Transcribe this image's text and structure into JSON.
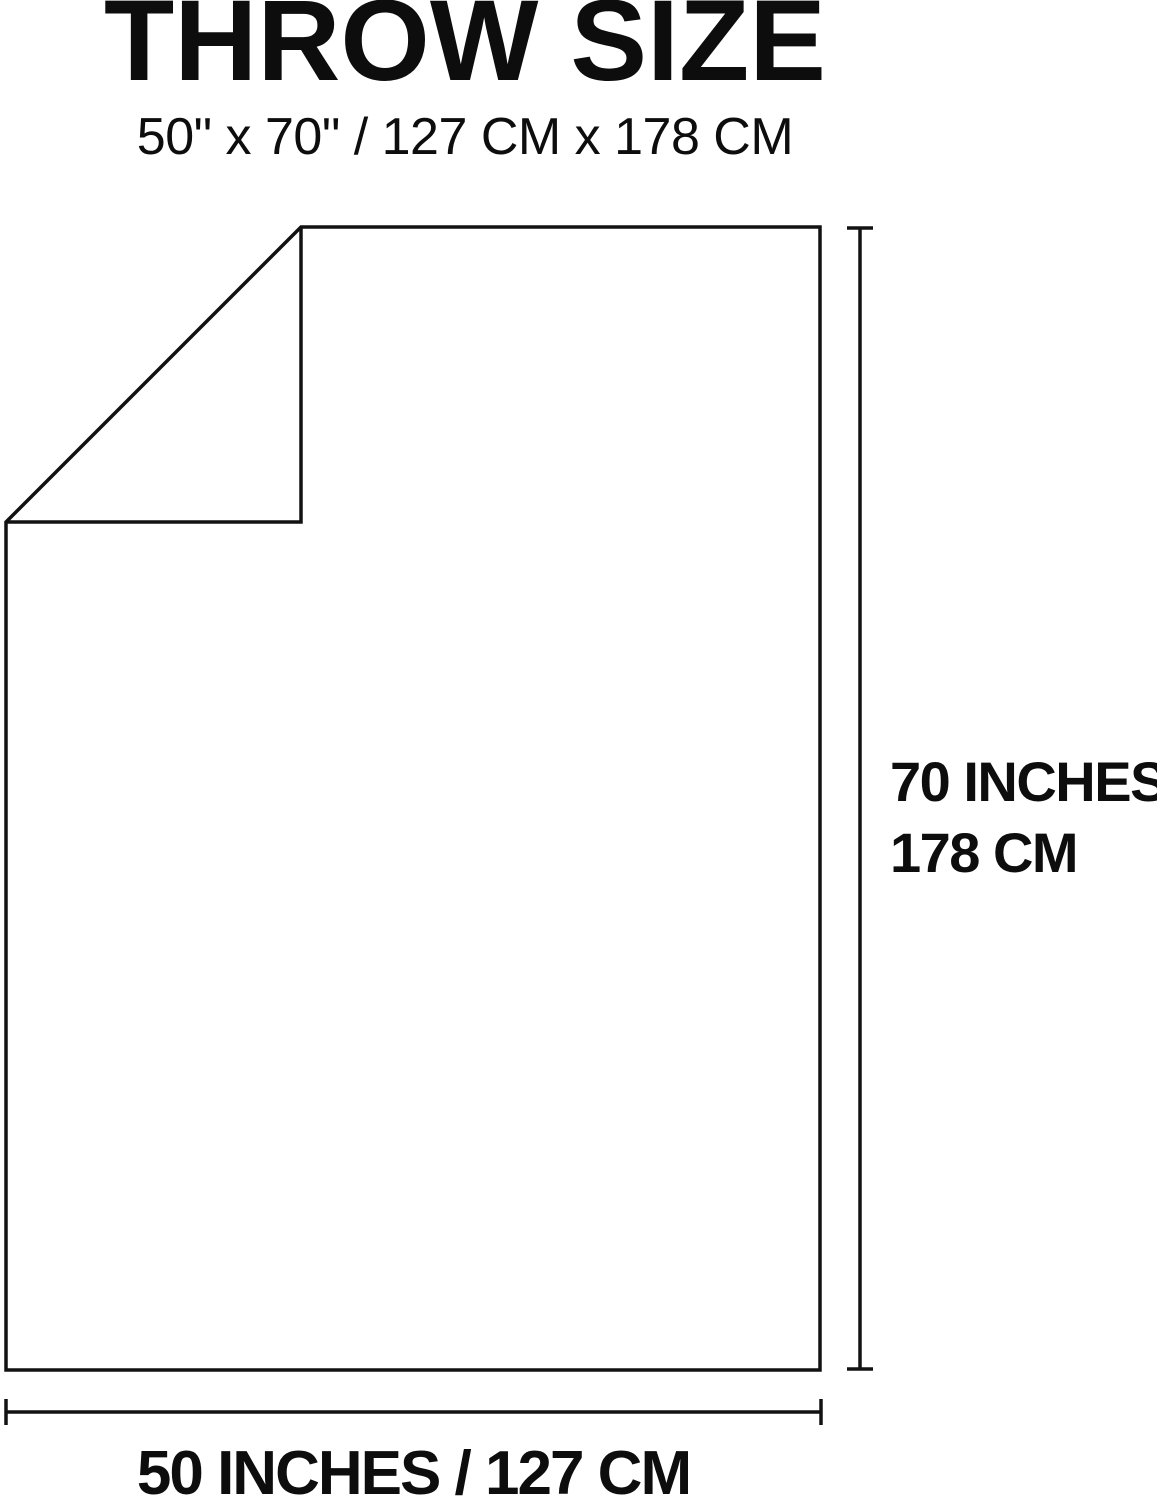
{
  "header": {
    "title": "THROW SIZE",
    "subtitle": "50\" x 70\" / 127 CM x 178 CM"
  },
  "diagram": {
    "line_color": "#121212",
    "background_color": "#ffffff",
    "height_dimension": {
      "line1": "70 INCHES",
      "line2": "178 CM"
    },
    "width_dimension": {
      "label": "50 INCHES / 127 CM"
    }
  }
}
